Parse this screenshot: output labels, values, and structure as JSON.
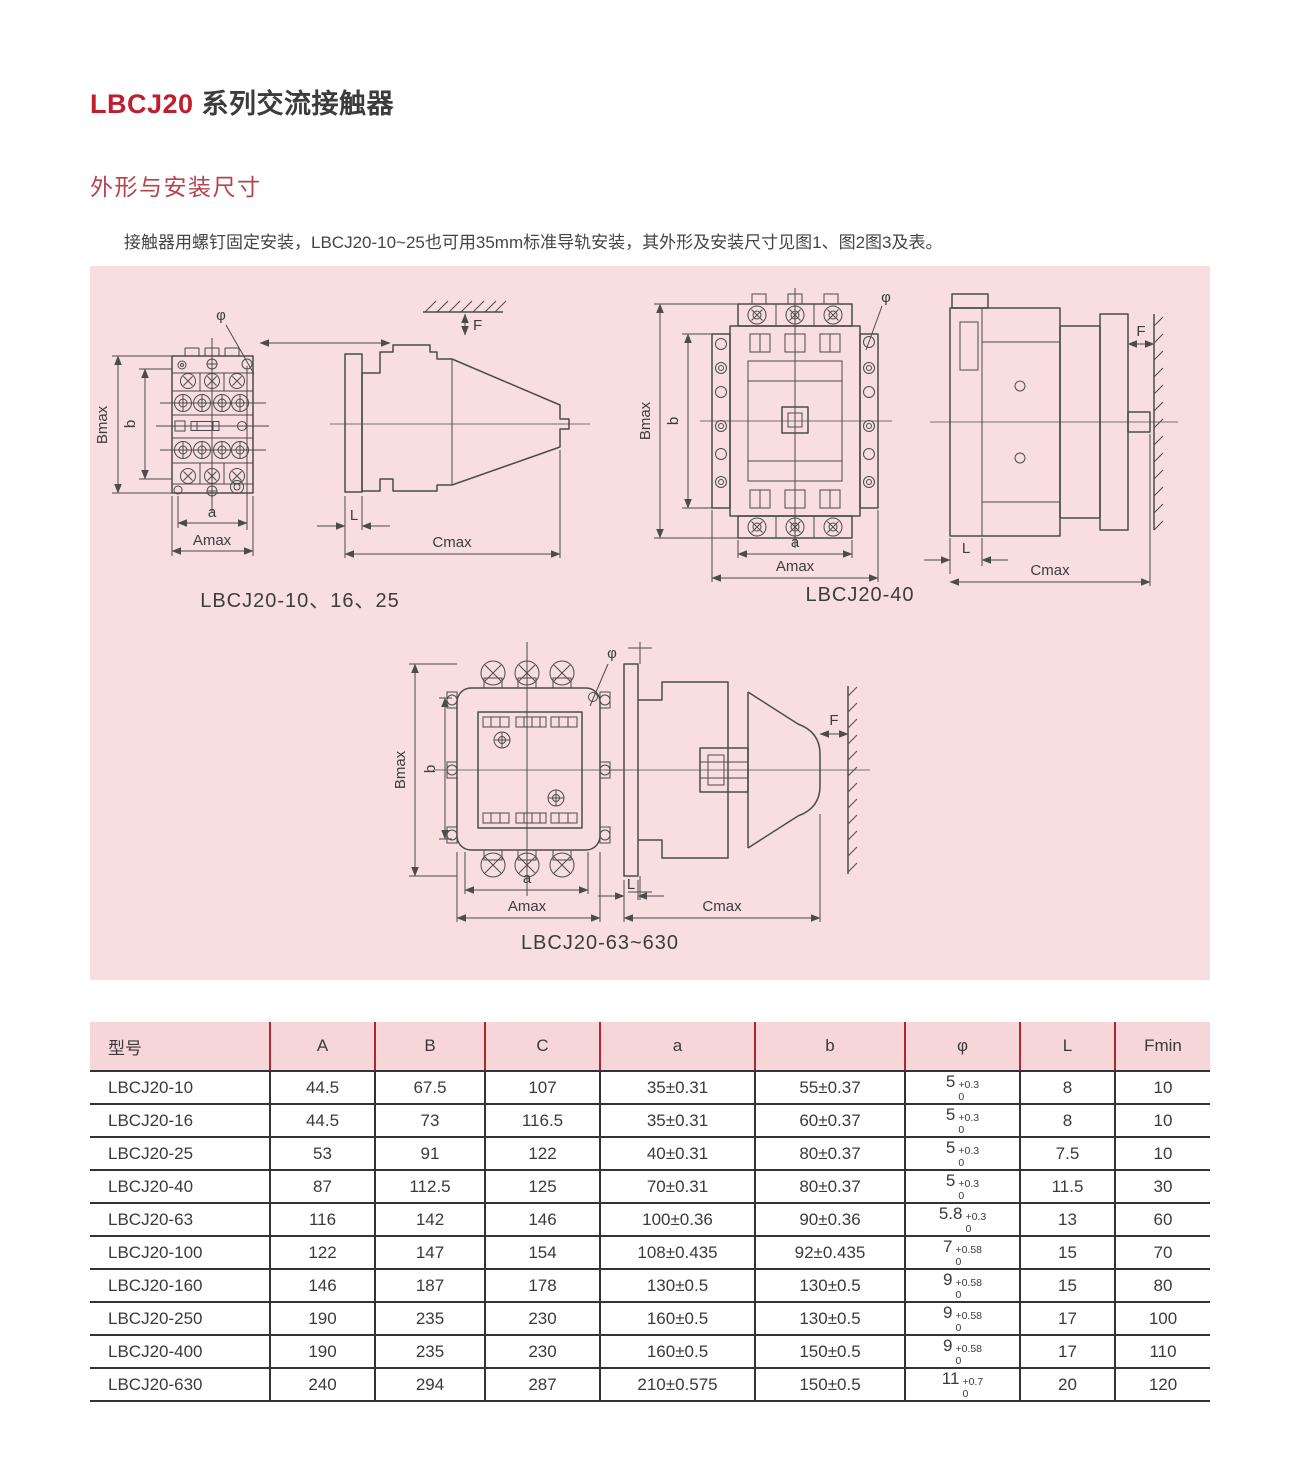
{
  "page": {
    "title_brand": "LBCJ20",
    "title_rest": "系列交流接触器",
    "section_heading": "外形与安装尺寸",
    "intro": "接触器用螺钉固定安装，LBCJ20-10~25也可用35mm标准导轨安装，其外形及安装尺寸见图1、图2图3及表。"
  },
  "colors": {
    "accent_red": "#bf1e2e",
    "heading_red": "#b2434f",
    "panel_pink": "#f8dde1",
    "table_header_pink": "#f7d6da",
    "table_header_divider_red": "#b42432"
  },
  "figures": {
    "captions": {
      "fig1": "LBCJ20-10、16、25",
      "fig2": "LBCJ20-40",
      "fig3": "LBCJ20-63~630"
    },
    "labels": {
      "Bmax": "Bmax",
      "b": "b",
      "a": "a",
      "Amax": "Amax",
      "Cmax": "Cmax",
      "L": "L",
      "F": "F",
      "phi": "φ"
    }
  },
  "table": {
    "headers": [
      "型号",
      "A",
      "B",
      "C",
      "a",
      "b",
      "φ",
      "L",
      "Fmin"
    ],
    "rows": [
      {
        "cells": [
          "LBCJ20-10",
          "44.5",
          "67.5",
          "107",
          "35±0.31",
          "55±0.37",
          {
            "base": "5",
            "upper": "+0.3",
            "lower": "0"
          },
          "8",
          "10"
        ]
      },
      {
        "cells": [
          "LBCJ20-16",
          "44.5",
          "73",
          "116.5",
          "35±0.31",
          "60±0.37",
          {
            "base": "5",
            "upper": "+0.3",
            "lower": "0"
          },
          "8",
          "10"
        ]
      },
      {
        "cells": [
          "LBCJ20-25",
          "53",
          "91",
          "122",
          "40±0.31",
          "80±0.37",
          {
            "base": "5",
            "upper": "+0.3",
            "lower": "0"
          },
          "7.5",
          "10"
        ]
      },
      {
        "cells": [
          "LBCJ20-40",
          "87",
          "112.5",
          "125",
          "70±0.31",
          "80±0.37",
          {
            "base": "5",
            "upper": "+0.3",
            "lower": "0"
          },
          "11.5",
          "30"
        ]
      },
      {
        "cells": [
          "LBCJ20-63",
          "116",
          "142",
          "146",
          "100±0.36",
          "90±0.36",
          {
            "base": "5.8",
            "upper": "+0.3",
            "lower": "0"
          },
          "13",
          "60"
        ]
      },
      {
        "cells": [
          "LBCJ20-100",
          "122",
          "147",
          "154",
          "108±0.435",
          "92±0.435",
          {
            "base": "7",
            "upper": "+0.58",
            "lower": "0"
          },
          "15",
          "70"
        ]
      },
      {
        "cells": [
          "LBCJ20-160",
          "146",
          "187",
          "178",
          "130±0.5",
          "130±0.5",
          {
            "base": "9",
            "upper": "+0.58",
            "lower": "0"
          },
          "15",
          "80"
        ]
      },
      {
        "cells": [
          "LBCJ20-250",
          "190",
          "235",
          "230",
          "160±0.5",
          "130±0.5",
          {
            "base": "9",
            "upper": "+0.58",
            "lower": "0"
          },
          "17",
          "100"
        ]
      },
      {
        "cells": [
          "LBCJ20-400",
          "190",
          "235",
          "230",
          "160±0.5",
          "150±0.5",
          {
            "base": "9",
            "upper": "+0.58",
            "lower": "0"
          },
          "17",
          "110"
        ]
      },
      {
        "cells": [
          "LBCJ20-630",
          "240",
          "294",
          "287",
          "210±0.575",
          "150±0.5",
          {
            "base": "11",
            "upper": "+0.7",
            "lower": "0"
          },
          "20",
          "120"
        ]
      }
    ]
  }
}
